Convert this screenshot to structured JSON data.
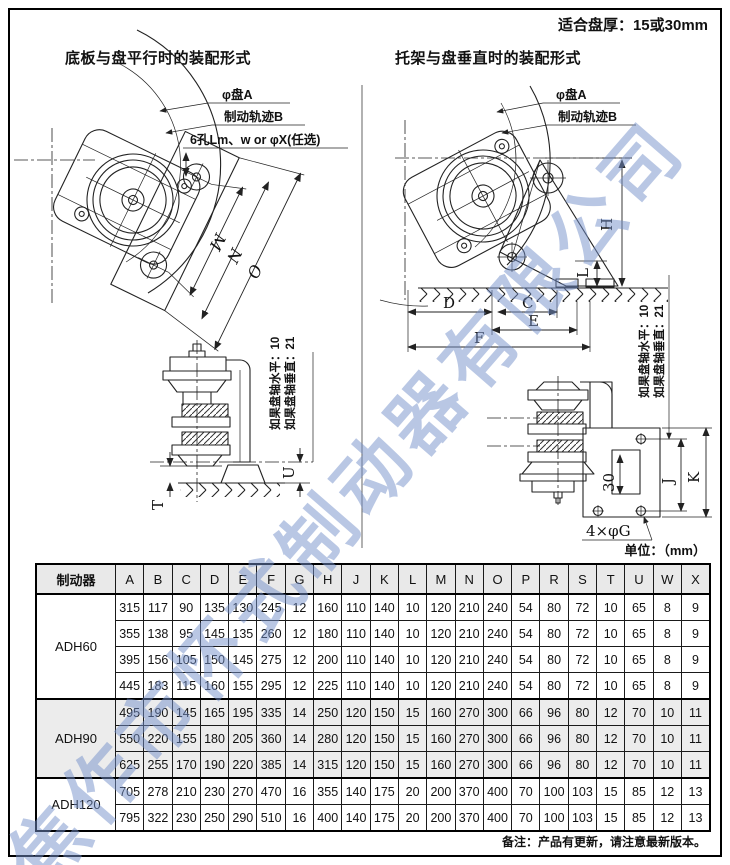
{
  "page": {
    "top_note": "适合盘厚：15或30mm",
    "unit_label": "单位：（mm）",
    "footer_note": "备注：产品有更新，请注意最新版本。",
    "watermark": "焦作市怀式制动器有限公司"
  },
  "diagrams": {
    "left": {
      "title": "底板与盘平行时的装配形式",
      "label_disc": "φ盘A",
      "label_track": "制动轨迹B",
      "label_holes": "6孔Lm、w or φX(任选)",
      "dim_m": "M",
      "dim_n": "N",
      "dim_o": "O"
    },
    "right": {
      "title": "托架与盘垂直时的装配形式",
      "label_disc": "φ盘A",
      "label_track": "制动轨迹B",
      "dim_h": "H",
      "dim_l": "L",
      "dim_d": "D",
      "dim_c": "C",
      "dim_e": "E",
      "dim_f": "F"
    },
    "side_left": {
      "note1": "如果盘轴水平：10",
      "note2": "如果盘轴垂直：21",
      "dim_t": "T",
      "dim_u": "U"
    },
    "side_right": {
      "note1": "如果盘轴水平：10",
      "note2": "如果盘轴垂直：21",
      "dim_j": "J",
      "dim_k": "K",
      "dim_30": "30",
      "label_holes": "4×φG"
    }
  },
  "table": {
    "col0_header": "制动器",
    "columns": [
      "A",
      "B",
      "C",
      "D",
      "E",
      "F",
      "G",
      "H",
      "J",
      "K",
      "L",
      "M",
      "N",
      "O",
      "P",
      "R",
      "S",
      "T",
      "U",
      "W",
      "X"
    ],
    "groups": [
      {
        "model": "ADH60",
        "shaded": false,
        "rows": [
          [
            "315",
            "117",
            "90",
            "135",
            "130",
            "245",
            "12",
            "160",
            "110",
            "140",
            "10",
            "120",
            "210",
            "240",
            "54",
            "80",
            "72",
            "10",
            "65",
            "8",
            "9"
          ],
          [
            "355",
            "138",
            "95",
            "145",
            "135",
            "260",
            "12",
            "180",
            "110",
            "140",
            "10",
            "120",
            "210",
            "240",
            "54",
            "80",
            "72",
            "10",
            "65",
            "8",
            "9"
          ],
          [
            "395",
            "156",
            "105",
            "150",
            "145",
            "275",
            "12",
            "200",
            "110",
            "140",
            "10",
            "120",
            "210",
            "240",
            "54",
            "80",
            "72",
            "10",
            "65",
            "8",
            "9"
          ],
          [
            "445",
            "183",
            "115",
            "160",
            "155",
            "295",
            "12",
            "225",
            "110",
            "140",
            "10",
            "120",
            "210",
            "240",
            "54",
            "80",
            "72",
            "10",
            "65",
            "8",
            "9"
          ]
        ]
      },
      {
        "model": "ADH90",
        "shaded": true,
        "rows": [
          [
            "495",
            "190",
            "145",
            "165",
            "195",
            "335",
            "14",
            "250",
            "120",
            "150",
            "15",
            "160",
            "270",
            "300",
            "66",
            "96",
            "80",
            "12",
            "70",
            "10",
            "11"
          ],
          [
            "550",
            "220",
            "155",
            "180",
            "205",
            "360",
            "14",
            "280",
            "120",
            "150",
            "15",
            "160",
            "270",
            "300",
            "66",
            "96",
            "80",
            "12",
            "70",
            "10",
            "11"
          ],
          [
            "625",
            "255",
            "170",
            "190",
            "220",
            "385",
            "14",
            "315",
            "120",
            "150",
            "15",
            "160",
            "270",
            "300",
            "66",
            "96",
            "80",
            "12",
            "70",
            "10",
            "11"
          ]
        ]
      },
      {
        "model": "ADH120",
        "shaded": false,
        "rows": [
          [
            "705",
            "278",
            "210",
            "230",
            "270",
            "470",
            "16",
            "355",
            "140",
            "175",
            "20",
            "200",
            "370",
            "400",
            "70",
            "100",
            "103",
            "15",
            "85",
            "12",
            "13"
          ],
          [
            "795",
            "322",
            "230",
            "250",
            "290",
            "510",
            "16",
            "400",
            "140",
            "175",
            "20",
            "200",
            "370",
            "400",
            "70",
            "100",
            "103",
            "15",
            "85",
            "12",
            "13"
          ]
        ]
      }
    ]
  }
}
